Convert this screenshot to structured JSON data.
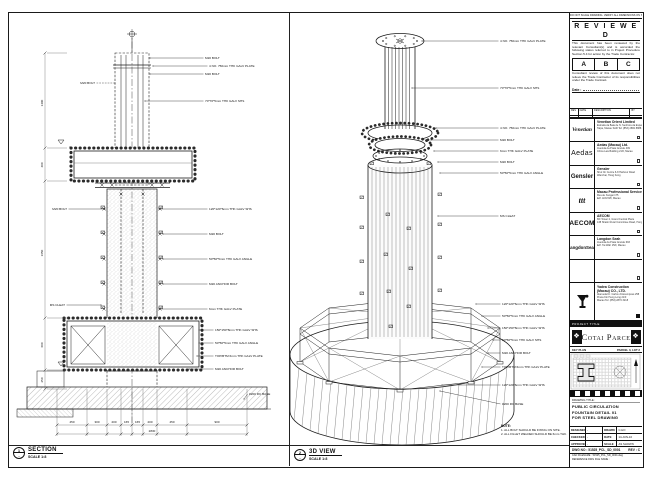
{
  "sheet": {
    "bg": "#ffffff",
    "ink": "#1c1c1c"
  },
  "views": {
    "section": {
      "bubble_top": "1",
      "bubble_bottom": "-",
      "title": "SECTION",
      "scale": "SCALE 1:8"
    },
    "iso": {
      "bubble_top": "2",
      "bubble_bottom": "-",
      "title": "3D VIEW",
      "scale": "SCALE 1:8"
    }
  },
  "note": {
    "title": "NOTE:",
    "lines": [
      "1. ALL BOLT SHOULD BE FIXING ON SITE.",
      "2. ALL FILLET WELDED SHOULD BE 6mm THK."
    ]
  },
  "stamp": {
    "top_note": "DO NOT SCALE DRAWING. VERIFY ALL DIMENSIONS ON SITE.",
    "title": "R E V I E W E D",
    "para1": "This document has been reviewed by the relevant Consultant(s) and is accorded the following status referred to in Project Procedure Section 5.4 for action by the Trade Contractor.",
    "options": [
      "A",
      "B",
      "C"
    ],
    "para2": "Consultant review of this document does not relieve the Trade Contractor of its responsibilities under the Trade Contract.",
    "date_label": "Date :"
  },
  "revision_strip": {
    "cols": [
      "REV",
      "DATE",
      "DESCRIPTION",
      "BY"
    ]
  },
  "companies": [
    {
      "logo": "Venetian",
      "name": "Venetian Orient Limited",
      "addr1": "Estrada da Baia de N. Senhora da Esperanca, s/n",
      "addr2": "Taipa, Macau SAR   Tel: (853) 2882 8888"
    },
    {
      "logo": "Aedas",
      "name": "Aedas (Macau) Ltd.",
      "addr1": "Avenida da Praia Grande 409",
      "addr2": "China Law Building 21/F, Macau"
    },
    {
      "logo": "Gensler",
      "name": "Gensler",
      "addr1": "Shui On Centre 6-8 Harbour Road",
      "addr2": "Wanchai, Hong Kong"
    },
    {
      "logo": "ttt",
      "name": "Macau Professional Services Ltd.",
      "addr1": "Rua de Xangai 175",
      "addr2": "Edf. ACM 8/F, Macau"
    },
    {
      "logo": "AECOM",
      "name": "AECOM",
      "addr1": "8/F Tower 2, Grand Central Plaza",
      "addr2": "138 Shatin Rural Committee Road, Hong Kong"
    },
    {
      "logo": "LangdonSeah",
      "name": "Langdon Seah",
      "addr1": "Avenida da Praia Grande 693",
      "addr2": "Edf. Tai Wah 15/F, Macau"
    },
    {
      "logo": "",
      "name": "",
      "addr1": "",
      "addr2": ""
    }
  ],
  "contractor": {
    "name": "Yadea Construction (Macau) CO., LTD.",
    "addr1": "Alameda Dr. Carlos d'Assumpcao 258",
    "addr2": "Praca Kin Heng Long 21/F",
    "addr3": "Macau   Tel: (853) 2870 3218"
  },
  "project": {
    "bar_label": "PROJECT TITLE",
    "name": "Cotai Parcel 3",
    "ornament": "❖"
  },
  "key_plan": {
    "label": "KEY PLAN",
    "right_label": "PARCEL 3, LOT 2"
  },
  "drawing_title": {
    "label": "DRAWING TITLE :",
    "lines": [
      "PUBLIC CIRCULATION",
      "FOUNTAIN DETAIL 01",
      "FOR STEEL DRAWING"
    ]
  },
  "approval": {
    "rows": [
      {
        "k1": "DESIGNED",
        "v1": "-",
        "k2": "DRAWN",
        "v2": "C.HO"
      },
      {
        "k1": "CHECKED",
        "v1": "-",
        "k2": "DATE",
        "v2": "14-JUN-10"
      },
      {
        "k1": "APPROVED",
        "v1": "-",
        "k2": "SCALE",
        "v2": "AS SHOWN"
      }
    ],
    "dwg_label": "DWG NO :",
    "dwg_no": "51525_PCL_SD_0001",
    "rev_label": "REV :",
    "rev": "C",
    "cad_label": "CAD FILENAME :",
    "cad": "51525_PCL_SD_0001.dwg",
    "ref_label": "REFERENCE DWG FILE NAME :"
  },
  "left_annotations": [
    {
      "t": "M20 BOLT",
      "lx": 141,
      "ly": 45,
      "tx": 196,
      "ty": 46,
      "a": "start"
    },
    {
      "t": "4 NO. 750mm THK GALV PLATE",
      "lx": 144,
      "ly": 53,
      "tx": 200,
      "ty": 54,
      "a": "start"
    },
    {
      "t": "M20 BOLT",
      "lx": 141,
      "ly": 61,
      "tx": 196,
      "ty": 62,
      "a": "start"
    },
    {
      "t": "70*70*5mm THK GALV SHS",
      "lx": 136,
      "ly": 88,
      "tx": 196,
      "ty": 89,
      "a": "start"
    },
    {
      "t": "120*120*6mm THK GALV SHS",
      "lx": 150,
      "ly": 196,
      "tx": 200,
      "ty": 197,
      "a": "start"
    },
    {
      "t": "M20 BOLT",
      "lx": 154,
      "ly": 221,
      "tx": 200,
      "ty": 222,
      "a": "start"
    },
    {
      "t": "50*50*5mm THK GALV ANGLE",
      "lx": 154,
      "ly": 246,
      "tx": 200,
      "ty": 247,
      "a": "start"
    },
    {
      "t": "M20 ANCHOR BOLT",
      "lx": 154,
      "ly": 271,
      "tx": 200,
      "ty": 272,
      "a": "start"
    },
    {
      "t": "6mm THK GALV PLATE",
      "lx": 150,
      "ly": 296,
      "tx": 200,
      "ty": 297,
      "a": "start"
    },
    {
      "t": "150*150*8mm THK GALV SHS",
      "lx": 190,
      "ly": 317,
      "tx": 206,
      "ty": 318,
      "a": "start"
    },
    {
      "t": "50*50*5mm THK GALV ANGLE",
      "lx": 190,
      "ly": 330,
      "tx": 206,
      "ty": 331,
      "a": "start"
    },
    {
      "t": "TOP/BTM 6mm THK GALV PLATE",
      "lx": 188,
      "ly": 343,
      "tx": 206,
      "ty": 344,
      "a": "start"
    },
    {
      "t": "M20 ANCHOR BOLT",
      "lx": 180,
      "ly": 356,
      "tx": 206,
      "ty": 357,
      "a": "start"
    },
    {
      "t": "#200 RC BASE",
      "lx": 235,
      "ly": 386,
      "tx": 240,
      "ty": 382,
      "a": "start"
    },
    {
      "t": "M20 BOLT",
      "lx": 106,
      "ly": 70,
      "tx": 86,
      "ty": 71,
      "a": "end",
      "d": true
    },
    {
      "t": "M20 BOLT",
      "lx": 96,
      "ly": 196,
      "tx": 58,
      "ty": 197,
      "a": "end"
    },
    {
      "t": "MS CLEAT",
      "lx": 92,
      "ly": 292,
      "tx": 56,
      "ty": 293,
      "a": "end"
    }
  ],
  "right_annotations": [
    {
      "t": "4 NO. 750mm THK GALV PLATE",
      "lx": 132,
      "ly": 28,
      "tx": 210,
      "ty": 29,
      "a": "start"
    },
    {
      "t": "70*70*5mm THK GALV SHS",
      "lx": 122,
      "ly": 75,
      "tx": 210,
      "ty": 76,
      "a": "start"
    },
    {
      "t": "4 NO. 750mm THK GALV PLATE",
      "lx": 146,
      "ly": 115,
      "tx": 210,
      "ty": 116,
      "a": "start"
    },
    {
      "t": "M20 BOLT",
      "lx": 141,
      "ly": 127,
      "tx": 210,
      "ty": 128,
      "a": "start"
    },
    {
      "t": "6mm THK GALV PLATE",
      "lx": 144,
      "ly": 138,
      "tx": 210,
      "ty": 139,
      "a": "start"
    },
    {
      "t": "M20 BOLT",
      "lx": 148,
      "ly": 149,
      "tx": 210,
      "ty": 150,
      "a": "start"
    },
    {
      "t": "50*50*5mm THK GALV ANGLE",
      "lx": 150,
      "ly": 160,
      "tx": 210,
      "ty": 161,
      "a": "start"
    },
    {
      "t": "MS CLEAT",
      "lx": 148,
      "ly": 203,
      "tx": 210,
      "ty": 204,
      "a": "start"
    },
    {
      "t": "120*120*6mm THK GALV SHS",
      "lx": 186,
      "ly": 291,
      "tx": 212,
      "ty": 292,
      "a": "start"
    },
    {
      "t": "50*50*5mm THK GALV ANGLE",
      "lx": 192,
      "ly": 303,
      "tx": 212,
      "ty": 304,
      "a": "start"
    },
    {
      "t": "150*150*8mm THK GALV SHS",
      "lx": 198,
      "ly": 315,
      "tx": 212,
      "ty": 316,
      "a": "start"
    },
    {
      "t": "50*50*5mm THK GALV SHS",
      "lx": 203,
      "ly": 327,
      "tx": 212,
      "ty": 328,
      "a": "start"
    },
    {
      "t": "M20 ANCHOR BOLT",
      "lx": 198,
      "ly": 340,
      "tx": 212,
      "ty": 341,
      "a": "start"
    },
    {
      "t": "TOP/BTM 6mm THK GALV PLATE",
      "lx": 192,
      "ly": 354,
      "tx": 212,
      "ty": 355,
      "a": "start"
    },
    {
      "t": "120*120*6mm THK GALV SHS",
      "lx": 152,
      "ly": 372,
      "tx": 212,
      "ty": 373,
      "a": "start"
    },
    {
      "t": "#200 RC BASE",
      "lx": 150,
      "ly": 378,
      "tx": 212,
      "ty": 392,
      "a": "start"
    }
  ],
  "left_dims_bottom": [
    {
      "t": "450",
      "x": 63
    },
    {
      "t": "300",
      "x": 88
    },
    {
      "t": "200",
      "x": 105
    },
    {
      "t": "165",
      "x": 117.5
    },
    {
      "t": "165",
      "x": 128.5
    },
    {
      "t": "200",
      "x": 141
    },
    {
      "t": "450",
      "x": 163
    },
    {
      "t": "900",
      "x": 208
    }
  ],
  "left_dim_total": {
    "t": "2830",
    "x": 143
  },
  "left_dims_side": [
    {
      "t": "1400",
      "y": 90
    },
    {
      "t": "400",
      "y": 152
    },
    {
      "t": "1650",
      "y": 240
    },
    {
      "t": "600",
      "y": 332
    },
    {
      "t": "250",
      "y": 367
    }
  ]
}
